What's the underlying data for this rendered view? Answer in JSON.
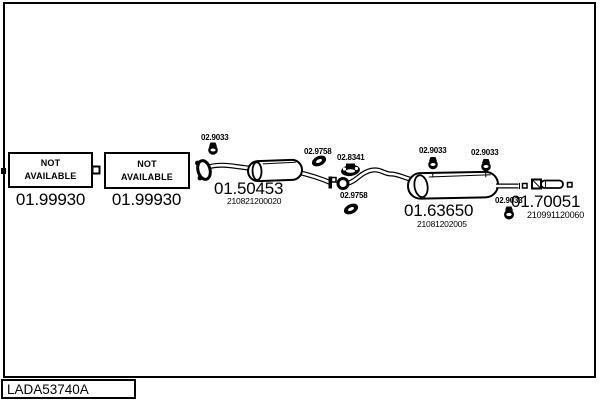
{
  "diagram": {
    "code": "LADA53740A",
    "colors": {
      "ink": "#000000",
      "background": "#ffffff"
    },
    "placeholders": [
      {
        "line1": "NOT",
        "line2": "AVAILABLE",
        "part_number": "01.99930"
      },
      {
        "line1": "NOT",
        "line2": "AVAILABLE",
        "part_number": "01.99930"
      }
    ],
    "main_parts": [
      {
        "name": "front-muffler",
        "part_number": "01.50453",
        "oe_number": "210821200020"
      },
      {
        "name": "rear-muffler",
        "part_number": "01.63650",
        "oe_number": "21081202005"
      },
      {
        "name": "tail-pipe-tip",
        "part_number": "01.70051",
        "oe_number": "210991120060"
      }
    ],
    "small_parts": [
      {
        "name": "rubber-hanger-front",
        "part_number": "02.9033"
      },
      {
        "name": "gasket-front",
        "part_number": "02.9758"
      },
      {
        "name": "clamp",
        "part_number": "02.8341"
      },
      {
        "name": "gasket-middle",
        "part_number": "02.9758"
      },
      {
        "name": "rubber-hanger-rear-left",
        "part_number": "02.9033"
      },
      {
        "name": "rubber-hanger-rear-right",
        "part_number": "02.9033"
      },
      {
        "name": "rubber-hanger-tail",
        "part_number": "02.9033"
      }
    ]
  }
}
